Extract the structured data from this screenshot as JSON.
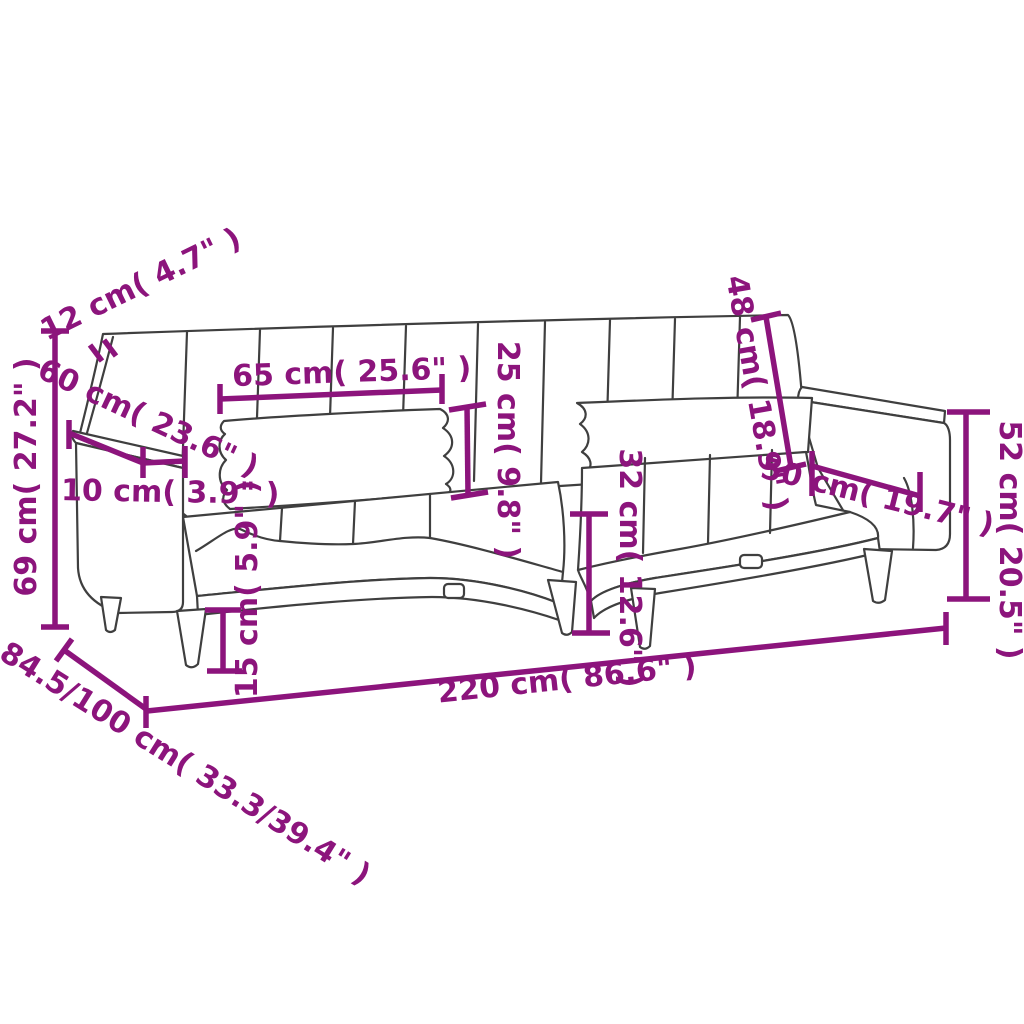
{
  "diagram": {
    "kind": "furniture-dimension-diagram",
    "subject": "2-seater sofa bed with two pillows, line drawing",
    "background_color": "#ffffff",
    "outline_color": "#3f3f3f",
    "dimension_color": "#8C147C"
  },
  "dimensions": {
    "d12": {
      "label": "12 cm( 4.7\" )",
      "cm": "12",
      "inch": "4.7"
    },
    "d69": {
      "label": "69 cm( 27.2\" )",
      "cm": "69",
      "inch": "27.2"
    },
    "d60": {
      "label": "60 cm( 23.6\" )",
      "cm": "60",
      "inch": "23.6"
    },
    "d10": {
      "label": "10 cm( 3.9\" )",
      "cm": "10",
      "inch": "3.9"
    },
    "d65": {
      "label": "65 cm( 25.6\" )",
      "cm": "65",
      "inch": "25.6"
    },
    "d25": {
      "label": "25 cm( 9.8\" )",
      "cm": "25",
      "inch": "9.8"
    },
    "d48": {
      "label": "48 cm( 18.9\" )",
      "cm": "48",
      "inch": "18.9"
    },
    "d52": {
      "label": "52 cm( 20.5\" )",
      "cm": "52",
      "inch": "20.5"
    },
    "d50": {
      "label": "50 cm( 19.7\" )",
      "cm": "50",
      "inch": "19.7"
    },
    "d32": {
      "label": "32 cm( 12.6\" )",
      "cm": "32",
      "inch": "12.6"
    },
    "d15": {
      "label": "15 cm( 5.9\" )",
      "cm": "15",
      "inch": "5.9"
    },
    "d220": {
      "label": "220 cm( 86.6\" )",
      "cm": "220",
      "inch": "86.6"
    },
    "d84": {
      "label": "84.5/100 cm( 33.3/39.4\" )",
      "cm": "84.5/100",
      "inch": "33.3/39.4"
    }
  }
}
